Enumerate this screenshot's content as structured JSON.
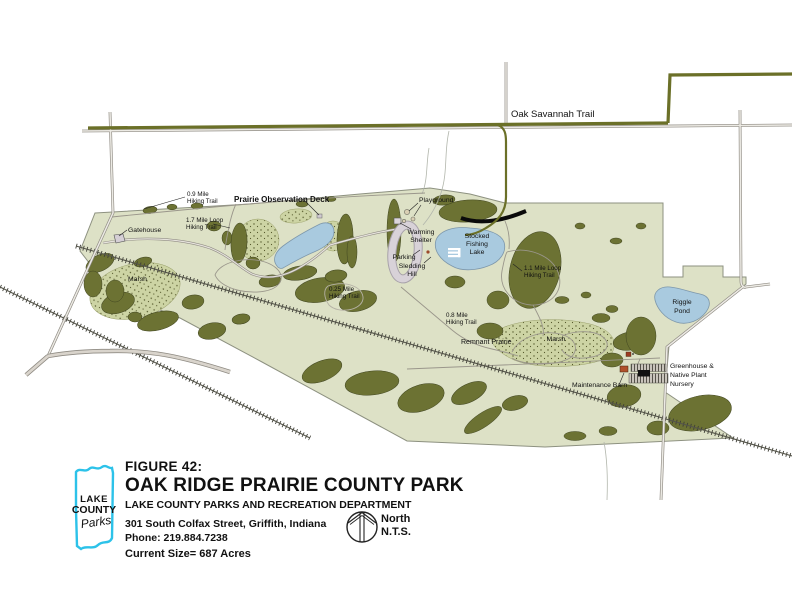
{
  "figure": {
    "number": "FIGURE 42:",
    "title": "OAK RIDGE PRAIRIE COUNTY PARK",
    "department": "LAKE COUNTY PARKS AND RECREATION DEPARTMENT",
    "address": "301 South Colfax Street, Griffith, Indiana",
    "phone": "Phone: 219.884.7238",
    "size": "Current Size= 687 Acres"
  },
  "logo": {
    "line1": "LAKE",
    "line2": "COUNTY",
    "line3": "Parks"
  },
  "north": {
    "label": "North",
    "scale": "N.T.S."
  },
  "map": {
    "labels": {
      "oak_savannah_trail": "Oak Savannah Trail",
      "trail_09_l1": "0.9 Mile",
      "trail_09_l2": "Hiking Trail",
      "prairie_observation_deck": "Prairie Observation Deck",
      "gatehouse": "Gatehouse",
      "marsh_west": "Marsh",
      "trail_17_l1": "1.7 Mile Loop",
      "trail_17_l2": "Hiking Trail",
      "playground": "Playground",
      "warming_l1": "Warming",
      "warming_l2": "Shelter",
      "parking": "Parking",
      "sledding_l1": "Sledding",
      "sledding_l2": "Hill",
      "stocked_l1": "Stocked",
      "stocked_l2": "Fishing",
      "stocked_l3": "Lake",
      "trail_11_l1": "1.1 Mile Loop",
      "trail_11_l2": "Hiking Trail",
      "trail_08_l1": "0.8 Mile",
      "trail_08_l2": "Hiking Trail",
      "trail_025_l1": "0.25 Mile",
      "trail_025_l2": "Hiking Trail",
      "remnant_prairie": "Remnant Prairie",
      "marsh_east": "Marsh",
      "riggle_l1": "Riggle",
      "riggle_l2": "Pond",
      "maintenance_barn": "Maintenance Barn",
      "greenhouse_l1": "Greenhouse &",
      "greenhouse_l2": "Native Plant",
      "greenhouse_l3": "Nursery"
    },
    "colors": {
      "park_fill": "#dde1c6",
      "vegetation": "#6c7233",
      "marsh_stipple": "#cdd4a4",
      "water": "#a9cadf",
      "trail_olive": "#6b7028",
      "road_gray": "#8f8b83",
      "logo_cyan": "#2cc2e9",
      "logo_purple": "#3d2a7d"
    }
  }
}
